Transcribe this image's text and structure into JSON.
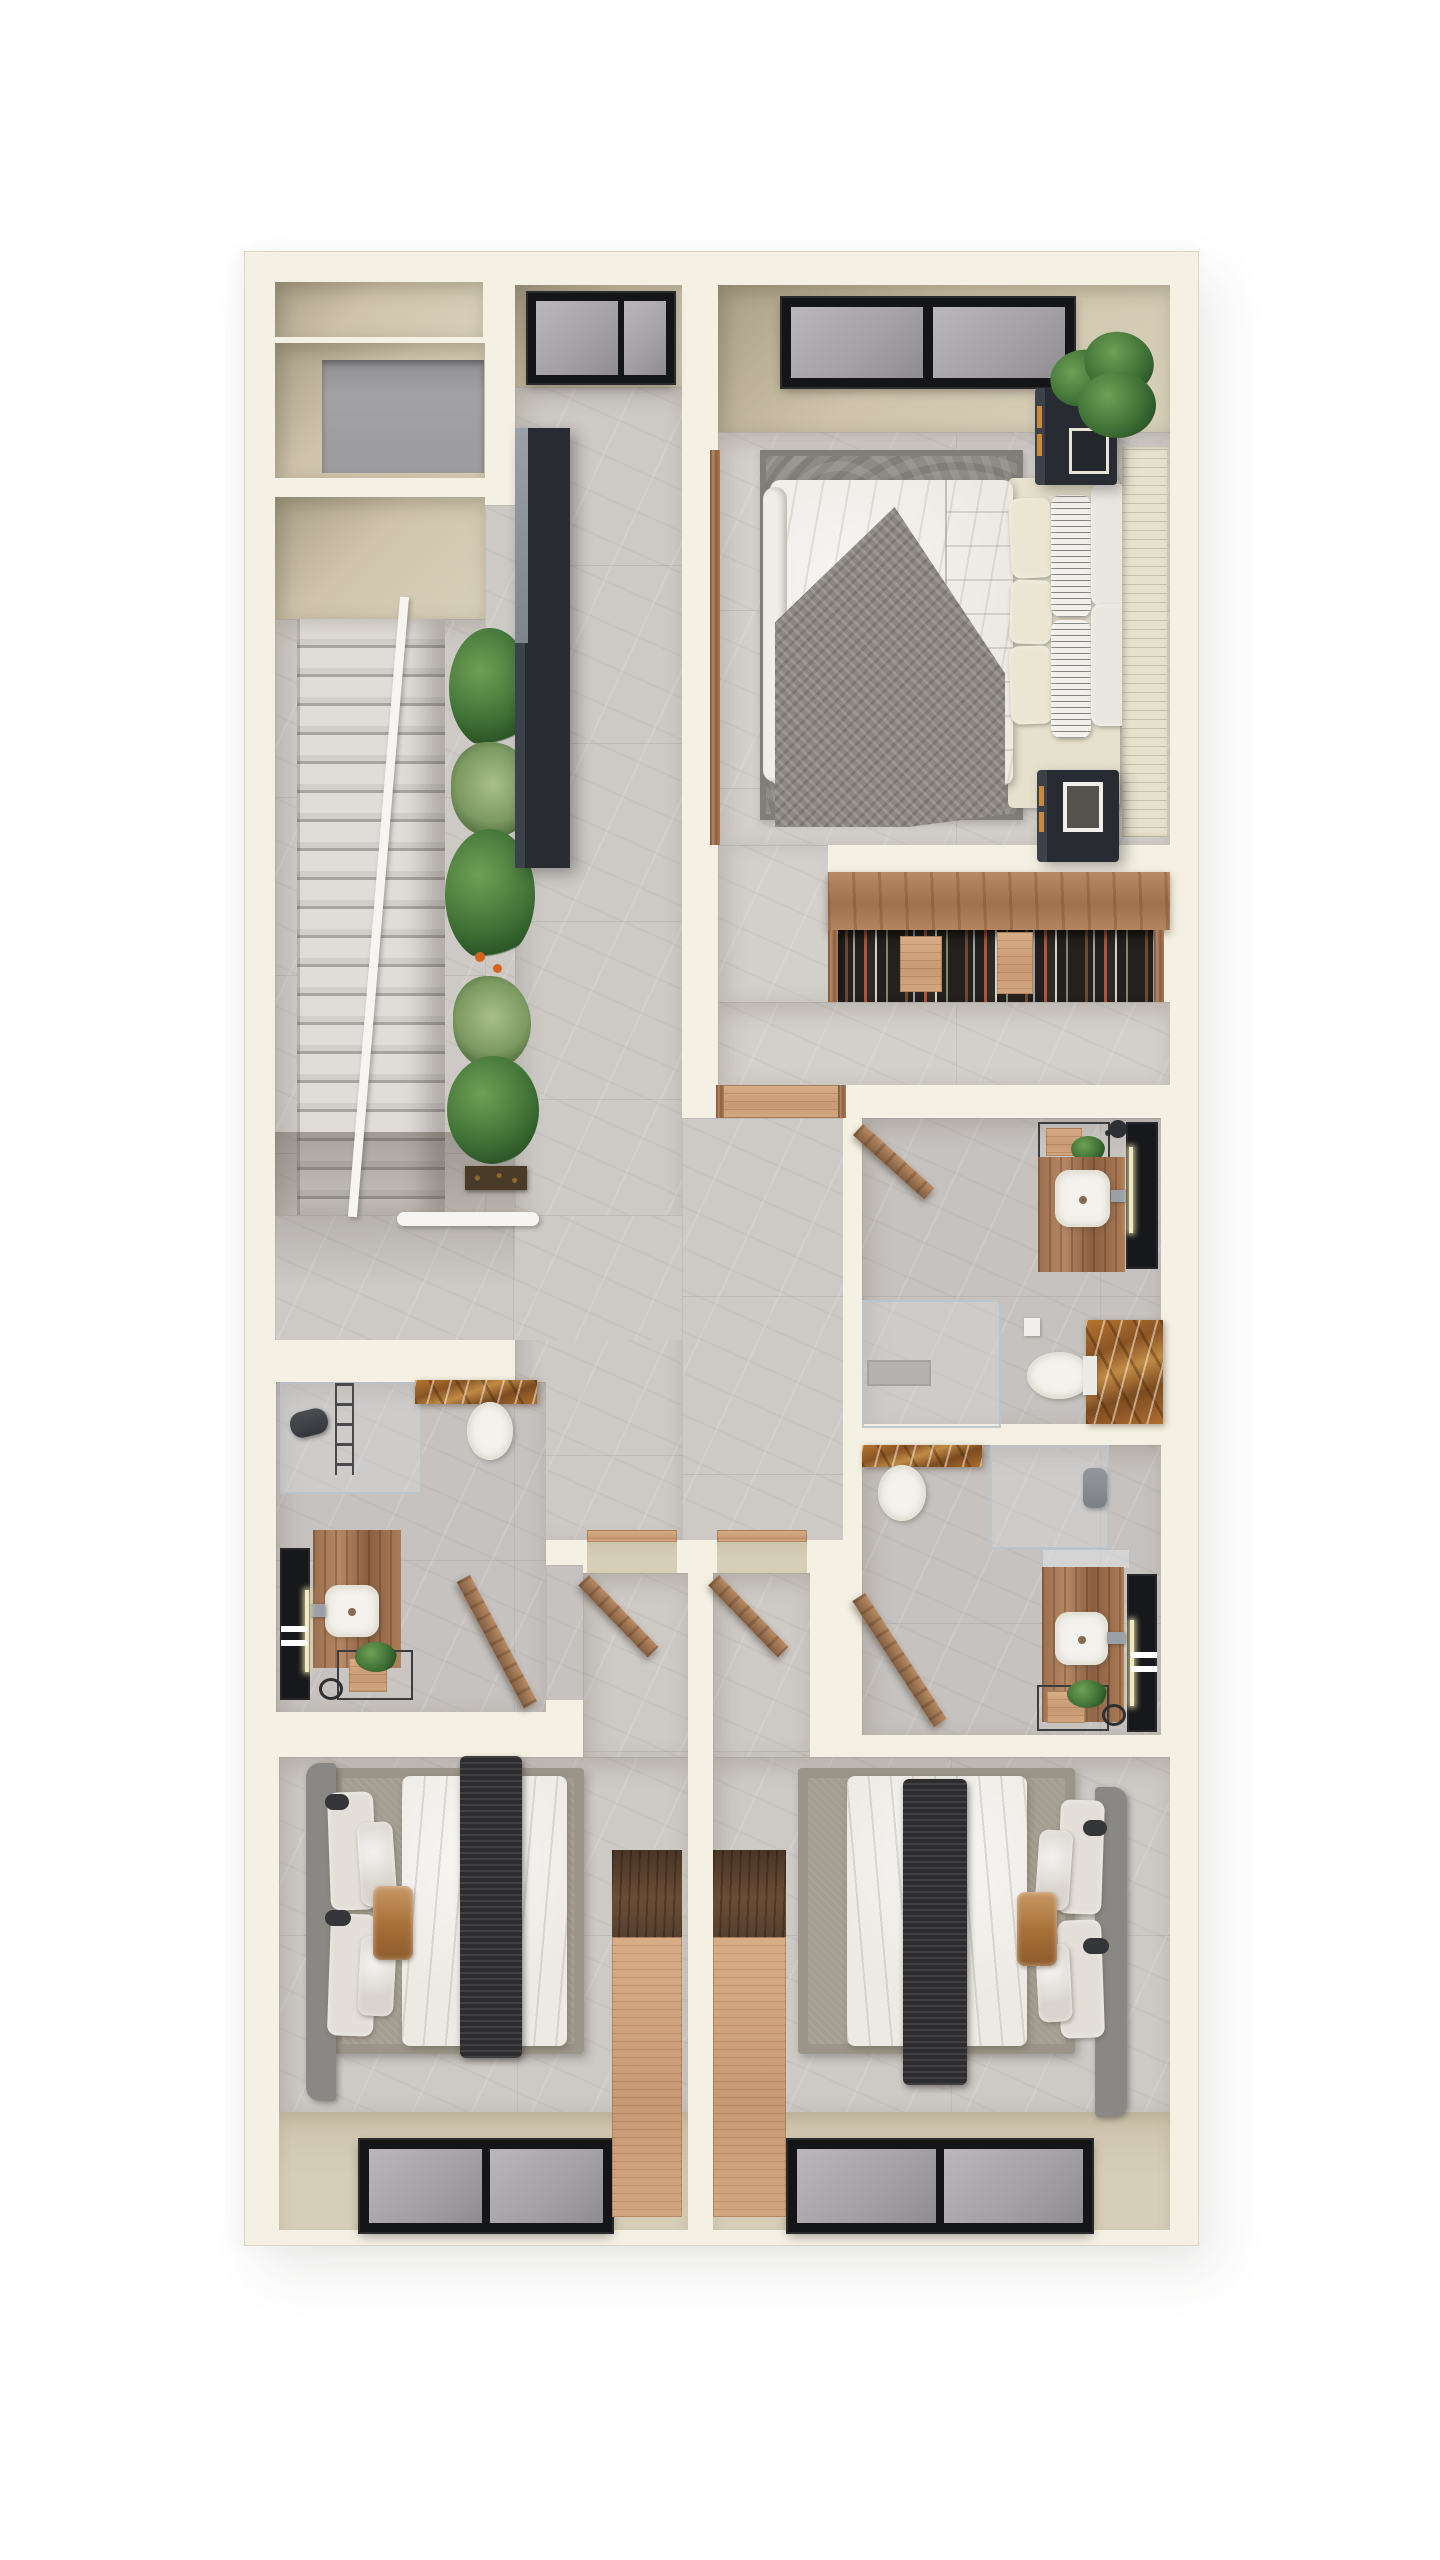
{
  "scene": {
    "type": "3d-floor-plan-render",
    "view": "top-down-dollhouse",
    "floor": "upper-storey",
    "background": "white"
  },
  "palette": {
    "page": "#ffffff",
    "wall": "#f4f0e3",
    "wall-edge": "#ddd6c2",
    "floor": "#cdc9c5",
    "floor-dark": "#c6c2bf",
    "floor-light": "#d3cfcb",
    "seam": "#b1ada9",
    "beige": "#cfc4ab",
    "beige-dark": "#a99e86",
    "beige-sill": "#d7ceb8",
    "gray-square": "#9c9c9e",
    "charcoal": "#24272c",
    "charcoal-light": "#878d95",
    "frame": "#141517",
    "glass": "#a3a0a3",
    "glass-light": "#bab7ba",
    "wood": "#a87a57",
    "wood-dark": "#7d563c",
    "wood-light": "#d2a77f",
    "walnut": "#5a4130",
    "rust": "#a96a2e",
    "rust-dark": "#7c4b20",
    "rust-light": "#cf9a55",
    "fixture": "#f4f2ec",
    "linen": "#edeae4",
    "linen-shadow": "#cfcbc4",
    "runner": "#2d2d2f",
    "platform": "#a39e91",
    "hb-gray": "#8a8884",
    "hb-cream": "#e6e1cd",
    "p-silver": "#d9d4cd",
    "p-cream": "#eae6d2",
    "p-brown": "#a9713a",
    "rug": "#8e8b85",
    "blanket": "#8d8781",
    "plant-dark": "#2c5527",
    "plant": "#3f7136",
    "plant-light": "#6fa055",
    "agave": "#7d9a63",
    "flower": "#d4651f",
    "steel": "#9aa0a5",
    "led": "#f1e9c2",
    "step": "#dcd8d4",
    "step-dark": "#a7a39f",
    "rail": "#f6f5f2"
  },
  "rooms": [
    {
      "name": "storage-niche-top-left"
    },
    {
      "name": "storage-room-gray-mat"
    },
    {
      "name": "stairwell",
      "features": [
        "stone-steps",
        "white-railing",
        "planter-strip"
      ]
    },
    {
      "name": "landing-hallway",
      "features": [
        "skylight-window",
        "black-wardrobe"
      ]
    },
    {
      "name": "master-bedroom",
      "features": [
        "double-bed",
        "two-nightstands",
        "potted-plant",
        "window"
      ]
    },
    {
      "name": "walk-in-closet",
      "features": [
        "bookshelf-wardrobe"
      ]
    },
    {
      "name": "bathroom-ensuite",
      "features": [
        "vanity-sink",
        "led-mirror",
        "toilet",
        "rust-marble-wall",
        "walk-in-shower",
        "wood-door"
      ]
    },
    {
      "name": "bathroom-middle",
      "features": [
        "vanity-sink",
        "led-mirror",
        "toilet",
        "rust-marble-strip",
        "shower",
        "towel-rack",
        "wood-door"
      ]
    },
    {
      "name": "bathroom-left",
      "features": [
        "vanity-sink",
        "led-mirror",
        "toilet",
        "rust-marble-strip",
        "shower",
        "ladder-towel-rack",
        "wood-door"
      ]
    },
    {
      "name": "bedroom-left",
      "features": [
        "double-bed",
        "wardrobe",
        "window",
        "wood-door"
      ]
    },
    {
      "name": "bedroom-right",
      "features": [
        "double-bed",
        "wardrobe",
        "window",
        "wood-door"
      ]
    }
  ],
  "furniture_counts": {
    "beds": 3,
    "toilets": 3,
    "sinks": 3,
    "windows": 4,
    "open-wood-doors": 5,
    "wardrobes": 4,
    "plants": 7
  }
}
